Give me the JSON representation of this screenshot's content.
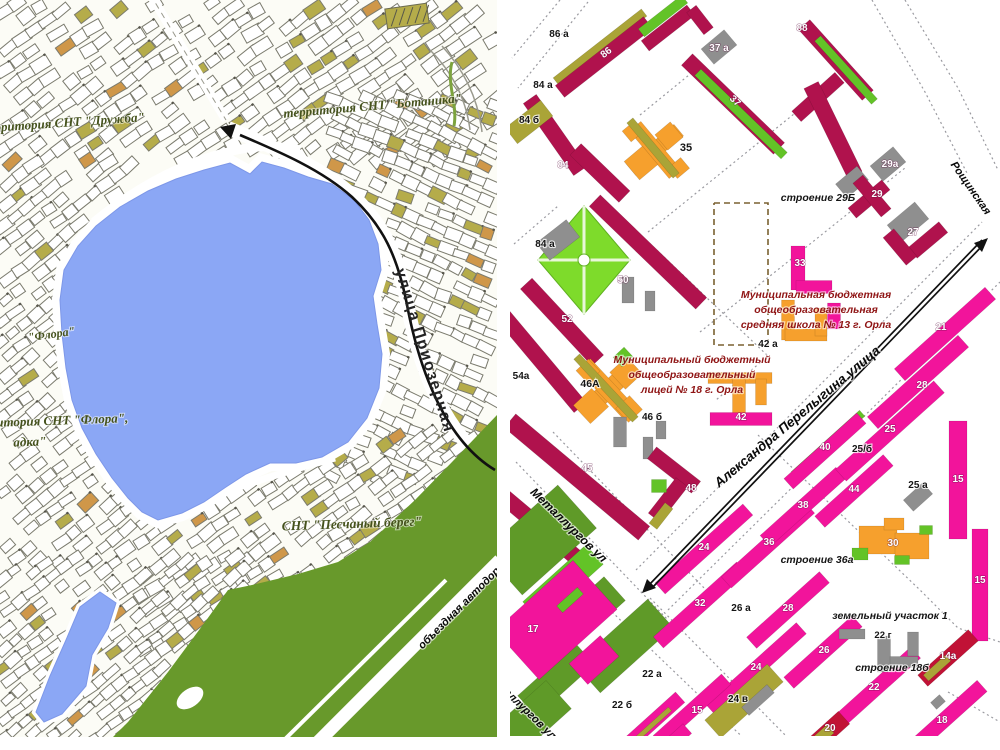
{
  "palette": {
    "page_bg": "#ffffff",
    "map_bg": "#fcfcf6",
    "lake": "#8ba7f5",
    "lake_edge": "#7d97e8",
    "forest": "#68992b",
    "forest2": "#5f9a28",
    "parcel_stroke": "#7b7b6e",
    "parcel_olive": "#b5ac4a",
    "parcel_orange": "#cf9749",
    "pink": "#f2149b",
    "crimson": "#b0124d",
    "dark_red": "#c11236",
    "orange": "#f6a02d",
    "olive": "#aaa437",
    "green": "#63c327",
    "park_green": "#7edb2b",
    "gray_bldg": "#8f8f8f",
    "cad_line": "#9a9aa0",
    "arrow": "#111111",
    "left_label": "#45521d",
    "school_text": "#8f1414"
  },
  "left_map": {
    "territory_labels": [
      {
        "id": "territory-druzhba",
        "text": "территория СНТ \"Дружба\"",
        "x": 62,
        "y": 127,
        "rot": -4,
        "size": 13
      },
      {
        "id": "territory-botanika",
        "text": "территория СНТ \"Ботаника\"",
        "x": 373,
        "y": 110,
        "rot": -5,
        "size": 13
      },
      {
        "id": "flora-small",
        "text": "\"Флора\"",
        "x": 52,
        "y": 338,
        "rot": -8,
        "size": 12
      },
      {
        "id": "territory-flora",
        "text": "территория СНТ \"Флора\",",
        "x": 48,
        "y": 425,
        "rot": -2,
        "size": 13
      },
      {
        "id": "territory-flora-2",
        "text": "адка\"",
        "x": 30,
        "y": 446,
        "rot": -2,
        "size": 13
      },
      {
        "id": "snt-peschany-bereg",
        "text": "СНТ \"Песчаный берег\"",
        "x": 352,
        "y": 528,
        "rot": -2,
        "size": 13.5
      }
    ],
    "street_labels": [
      {
        "id": "ulitsa-priozernaya",
        "text": "улица Приозерная",
        "x": 420,
        "y": 352,
        "rot": 73,
        "size": 16
      },
      {
        "id": "obyezdnaya-avtodoroga",
        "text": "объездная автодорога",
        "x": 468,
        "y": 604,
        "rot": -45,
        "size": 11
      }
    ]
  },
  "right_map": {
    "street_labels": [
      {
        "id": "perelygina-ulitsa",
        "text": "Александра Перелыгина улица",
        "x": 800,
        "y": 420,
        "rot": -40,
        "size": 13.5
      },
      {
        "id": "metallurgov-ul",
        "text": "Металлургов ул",
        "x": 566,
        "y": 528,
        "rot": 44,
        "size": 12
      },
      {
        "id": "metallurgov-ul-2",
        "text": "металлургов ул",
        "x": 519,
        "y": 708,
        "rot": 44,
        "size": 11
      },
      {
        "id": "roshchinskaya",
        "text": "Рощинская",
        "x": 968,
        "y": 190,
        "rot": 55,
        "size": 11
      }
    ],
    "school_notes": [
      {
        "id": "school-13-note",
        "cx": 816,
        "y0": 298,
        "lh": 15,
        "size": 10.5,
        "lines": [
          "Муниципальная бюджетная",
          "общеобразовательная",
          "средняя школа № 13 г. Орла"
        ]
      },
      {
        "id": "lyceum-18-note",
        "cx": 692,
        "y0": 363,
        "lh": 15,
        "size": 10.5,
        "lines": [
          "Муниципальный бюджетный",
          "общеобразовательный",
          "лицей № 18 г. Орла"
        ]
      }
    ],
    "black_labels": [
      {
        "text": "86 а",
        "x": 559,
        "y": 37,
        "size": 10
      },
      {
        "text": "84 а",
        "x": 543,
        "y": 88,
        "size": 10
      },
      {
        "text": "84 б",
        "x": 529,
        "y": 123,
        "size": 10
      },
      {
        "text": "35",
        "x": 686,
        "y": 151,
        "size": 11
      },
      {
        "text": "строение 29Б",
        "x": 818,
        "y": 201,
        "size": 10.5,
        "it": true
      },
      {
        "text": "84 а",
        "x": 545,
        "y": 247,
        "size": 10
      },
      {
        "text": "25/б",
        "x": 862,
        "y": 452,
        "size": 10
      },
      {
        "text": "25 а",
        "x": 918,
        "y": 488,
        "size": 10
      },
      {
        "text": "42 а",
        "x": 768,
        "y": 347,
        "size": 10
      },
      {
        "text": "46А",
        "x": 590,
        "y": 387,
        "size": 10.5
      },
      {
        "text": "46 б",
        "x": 652,
        "y": 420,
        "size": 10
      },
      {
        "text": "54а",
        "x": 521,
        "y": 379,
        "size": 10
      },
      {
        "text": "строение 36а",
        "x": 817,
        "y": 563,
        "size": 10.5,
        "it": true
      },
      {
        "text": "земельный участок 1",
        "x": 890,
        "y": 619,
        "size": 10.5,
        "it": true
      },
      {
        "text": "22 г",
        "x": 883,
        "y": 638,
        "size": 9.5
      },
      {
        "text": "строение 18б",
        "x": 892,
        "y": 671,
        "size": 10.5,
        "it": true
      },
      {
        "text": "26 а",
        "x": 741,
        "y": 611,
        "size": 10
      },
      {
        "text": "22 а",
        "x": 652,
        "y": 677,
        "size": 10
      },
      {
        "text": "22 б",
        "x": 622,
        "y": 708,
        "size": 10
      },
      {
        "text": "24 в",
        "x": 738,
        "y": 702,
        "size": 10
      },
      {
        "text": "25/б",
        "x": 0,
        "y": -100,
        "size": 1
      }
    ],
    "white_labels": [
      {
        "text": "86",
        "x": 608,
        "y": 55,
        "rot": -38
      },
      {
        "text": "88",
        "x": 802,
        "y": 31
      },
      {
        "text": "37",
        "x": 733,
        "y": 103,
        "rot": 44
      },
      {
        "text": "37 а",
        "x": 719,
        "y": 51
      },
      {
        "text": "84",
        "x": 563,
        "y": 168
      },
      {
        "text": "29а",
        "x": 890,
        "y": 167
      },
      {
        "text": "29",
        "x": 877,
        "y": 197
      },
      {
        "text": "27",
        "x": 913,
        "y": 235
      },
      {
        "text": "50",
        "x": 623,
        "y": 283
      },
      {
        "text": "52",
        "x": 567,
        "y": 322
      },
      {
        "text": "33",
        "x": 800,
        "y": 266
      },
      {
        "text": "45",
        "x": 587,
        "y": 471
      },
      {
        "text": "42",
        "x": 741,
        "y": 420
      },
      {
        "text": "48",
        "x": 691,
        "y": 491
      },
      {
        "text": "17",
        "x": 533,
        "y": 632
      },
      {
        "text": "21",
        "x": 941,
        "y": 330
      },
      {
        "text": "28",
        "x": 922,
        "y": 388
      },
      {
        "text": "25",
        "x": 890,
        "y": 432
      },
      {
        "text": "40",
        "x": 825,
        "y": 450
      },
      {
        "text": "44",
        "x": 854,
        "y": 492
      },
      {
        "text": "15",
        "x": 958,
        "y": 482
      },
      {
        "text": "38",
        "x": 803,
        "y": 508
      },
      {
        "text": "36",
        "x": 769,
        "y": 545
      },
      {
        "text": "30",
        "x": 893,
        "y": 546
      },
      {
        "text": "15",
        "x": 980,
        "y": 583
      },
      {
        "text": "28",
        "x": 788,
        "y": 611
      },
      {
        "text": "26",
        "x": 824,
        "y": 653
      },
      {
        "text": "24",
        "x": 756,
        "y": 670
      },
      {
        "text": "14а",
        "x": 948,
        "y": 659
      },
      {
        "text": "22",
        "x": 874,
        "y": 690
      },
      {
        "text": "18",
        "x": 942,
        "y": 723
      },
      {
        "text": "20",
        "x": 830,
        "y": 731
      },
      {
        "text": "24",
        "x": 704,
        "y": 550
      },
      {
        "text": "32",
        "x": 700,
        "y": 606
      },
      {
        "text": "15",
        "x": 697,
        "y": 713
      }
    ]
  }
}
